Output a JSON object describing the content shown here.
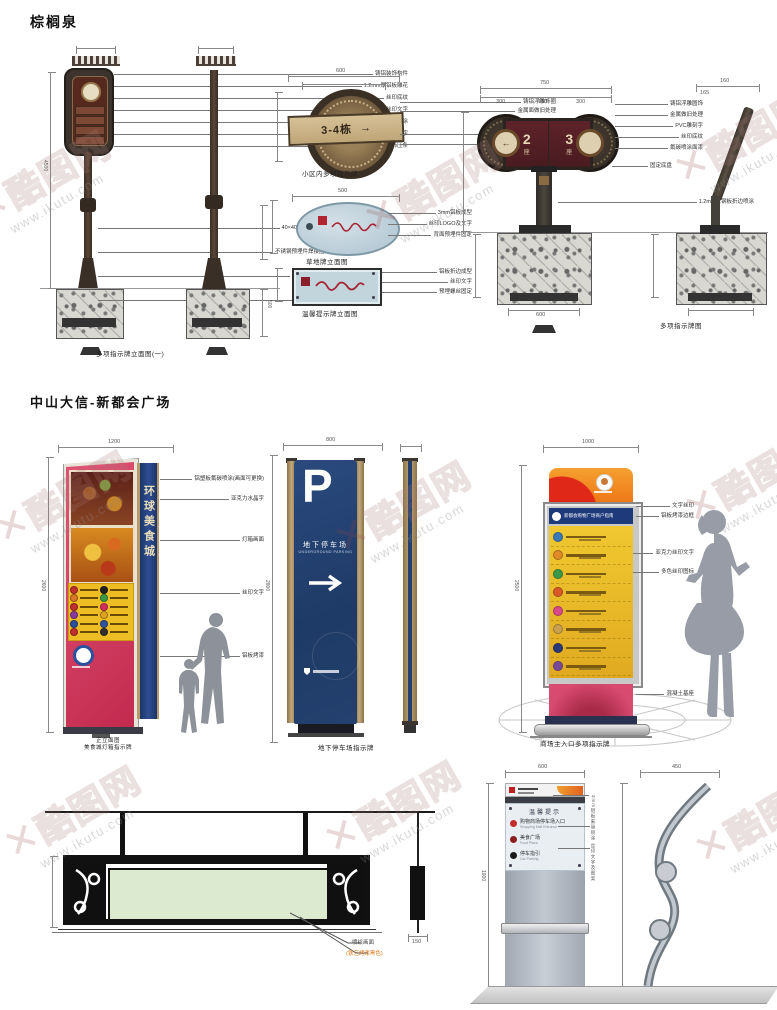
{
  "watermark": {
    "x": "✕",
    "brand": "酷图网",
    "url": "www.ikutu.com"
  },
  "s1": {
    "title": "棕榈泉",
    "postA": {
      "callouts": [
        "铸铝装饰构件",
        "1.2mm厚铝板雕花",
        "丝印底纹",
        "丝印文字",
        "3mm铝板氟碳喷涂",
        "1.2mm铝板折边字",
        "金属装饰压条"
      ],
      "base_callouts": [
        "40×40镀锌方管骨架",
        "不锈钢预埋件焊接固定",
        "C25混凝土浇铸",
        "素土夯实"
      ],
      "caption": "多项指示牌立面图(一)",
      "dim_h": "4500",
      "dim_found": "500"
    },
    "medallion": {
      "text": "3-4栋",
      "arrow": "→",
      "dim_top": "600",
      "callouts_a": [
        "铸铝浮雕饰圈",
        "金属面做旧处理"
      ],
      "callouts_b": [
        "3mm铝板雕刻字",
        "丝印指示箭头"
      ],
      "caption": "小区内多项指示牌"
    },
    "oval": {
      "dim_top": "500",
      "callouts": [
        "3mm铝板成型",
        "丝印LOGO及文字",
        "背面预埋件固定"
      ],
      "caption": "草地牌立面图"
    },
    "rect": {
      "callouts": [
        "铝板折边成型",
        "丝印文字",
        "预埋螺丝固定"
      ],
      "caption": "温馨提示牌立面图"
    },
    "signC": {
      "cells": [
        {
          "num": "2",
          "unit": "座"
        },
        {
          "num": "3",
          "unit": "座"
        }
      ],
      "arrow_l": "←",
      "arrow_r": "→",
      "dim_total": "750",
      "dim_segs": [
        "300",
        "150",
        "300"
      ],
      "dim_found": "600",
      "callouts": [
        "铸铝浮雕圆饰",
        "金属做旧处理",
        "PVC雕刻字",
        "丝印底纹",
        "氟碳喷涂面漆"
      ],
      "callout_base": "固定底盘",
      "callout_long": "1.2mm厚钢板折边喷涂",
      "caption": "多项指示牌图",
      "side_dim": "160",
      "side_dim2": "165"
    }
  },
  "s2": {
    "title": "中山大信-新都会广场",
    "food": {
      "side_text": "环球美食城",
      "dim_top": "1200",
      "dim_h": "2600",
      "callouts": [
        "铝塑板氟碳喷涂(画面可更换)",
        "亚克力水晶字",
        "灯箱画面",
        "丝印文字",
        "铝板烤漆"
      ],
      "caption1": "正立面图",
      "caption2": "美食城灯箱指示牌",
      "dots": [
        "#c03030",
        "#202020",
        "#d87828",
        "#3a9a48",
        "#c03030",
        "#d03060",
        "#8a3aa0",
        "#e0a020",
        "#2a50a0",
        "#3050a0",
        "#c03030",
        "#303030"
      ]
    },
    "parking": {
      "p": "P",
      "cn": "地下停车场",
      "en": "UNDERGROUND PARKING",
      "dim_top": "800",
      "dim_h": "2800",
      "caption": "地下停车场指示牌"
    },
    "directory": {
      "header": "新都会购物广场商户指南",
      "dim_top": "1000",
      "dim_h": "2500",
      "row_colors": [
        "#3a7ab8",
        "#e08a28",
        "#3a9a48",
        "#d85a28",
        "#d84a8a",
        "#c8a050",
        "#2a3a78",
        "#7a4a9a"
      ],
      "callouts": [
        "文字丝印",
        "铝板烤漆边框",
        "亚克力丝印文字",
        "多色丝印图标",
        "混凝土基座"
      ],
      "caption": "商场主入口多项指示牌"
    }
  },
  "s3": {
    "hanging": {
      "label1": "喷绘画面",
      "label2": "(铁艺烤漆黑色)",
      "side_dim": "150"
    },
    "kiosk": {
      "title": "温馨提示",
      "rows": [
        {
          "color": "#c03028",
          "text": "购物商场停车场入口",
          "en": "Shopping Mall Entrance"
        },
        {
          "color": "#8a2020",
          "text": "美食广场",
          "en": "Food Plaza"
        },
        {
          "color": "#1a1a1a",
          "text": "停车指引",
          "en": "Car Parking"
        }
      ],
      "dim_top": "600",
      "dim_h": "1900",
      "side_dim": "450",
      "spec_v": "3mm铝板氟碳喷涂 丝印文字及图案"
    }
  }
}
